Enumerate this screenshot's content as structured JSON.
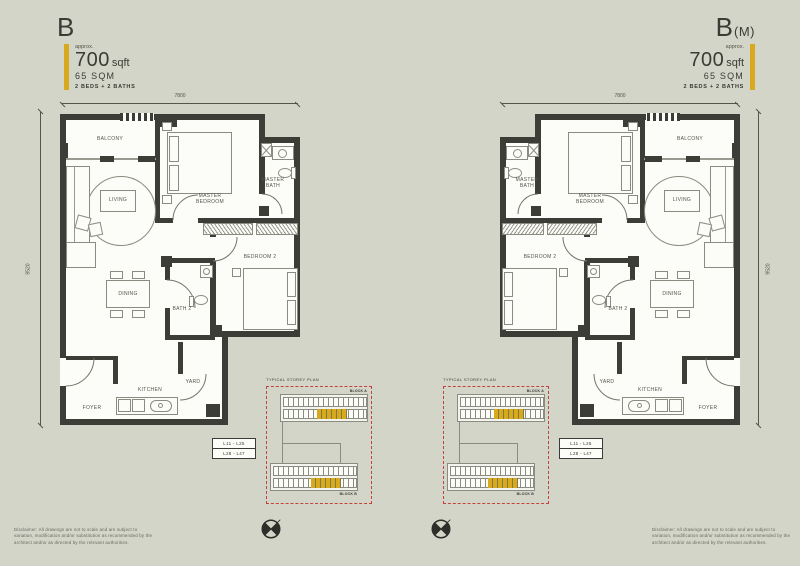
{
  "colors": {
    "background": "#d3d5c8",
    "wall": "#3d3d37",
    "gold": "#d9a91d",
    "red": "#c4423a",
    "text": "#3b3b35"
  },
  "icons": {
    "compass": "circle-cross-north"
  },
  "disclaimer": "Disclaimer: All drawings are not to scale and are subject to variation, modification and/or substitution as recommended by the architect and/or as directed by the relevant authorities.",
  "units": [
    {
      "id": "B",
      "title_main": "B",
      "title_paren": "",
      "approx": "approx.",
      "area_sqft": "700",
      "area_sqft_unit": "sqft",
      "area_sqm": "65 SQM",
      "beds_baths": "2 BEDS + 2 BATHS",
      "dim_top": "7800",
      "dim_side": "9520",
      "rooms": {
        "balcony": "BALCONY",
        "living": "LIVING",
        "master_bedroom": "MASTER BEDROOM",
        "master_bath": "MASTER BATH",
        "bedroom2": "BEDROOM 2",
        "dining": "DINING",
        "bath2": "BATH 2",
        "kitchen": "KITCHEN",
        "yard": "YARD",
        "foyer": "FOYER"
      },
      "storey_plan": {
        "title": "TYPICAL STOREY PLAN",
        "block_a": "BLOCK A",
        "block_b": "BLOCK B",
        "levels_line1": "L11 - L25",
        "levels_line2": "L28 - L47"
      }
    },
    {
      "id": "B(M)",
      "title_main": "B",
      "title_paren": "(M)",
      "approx": "approx.",
      "area_sqft": "700",
      "area_sqft_unit": "sqft",
      "area_sqm": "65 SQM",
      "beds_baths": "2 BEDS + 2 BATHS",
      "dim_top": "7800",
      "dim_side": "9520",
      "rooms": {
        "balcony": "BALCONY",
        "living": "LIVING",
        "master_bedroom": "MASTER BEDROOM",
        "master_bath": "MASTER BATH",
        "bedroom2": "BEDROOM 2",
        "dining": "DINING",
        "bath2": "BATH 2",
        "kitchen": "KITCHEN",
        "yard": "YARD",
        "foyer": "FOYER"
      },
      "storey_plan": {
        "title": "TYPICAL STOREY PLAN",
        "block_a": "BLOCK A",
        "block_b": "BLOCK B",
        "levels_line1": "L11 - L25",
        "levels_line2": "L28 - L47"
      }
    }
  ]
}
